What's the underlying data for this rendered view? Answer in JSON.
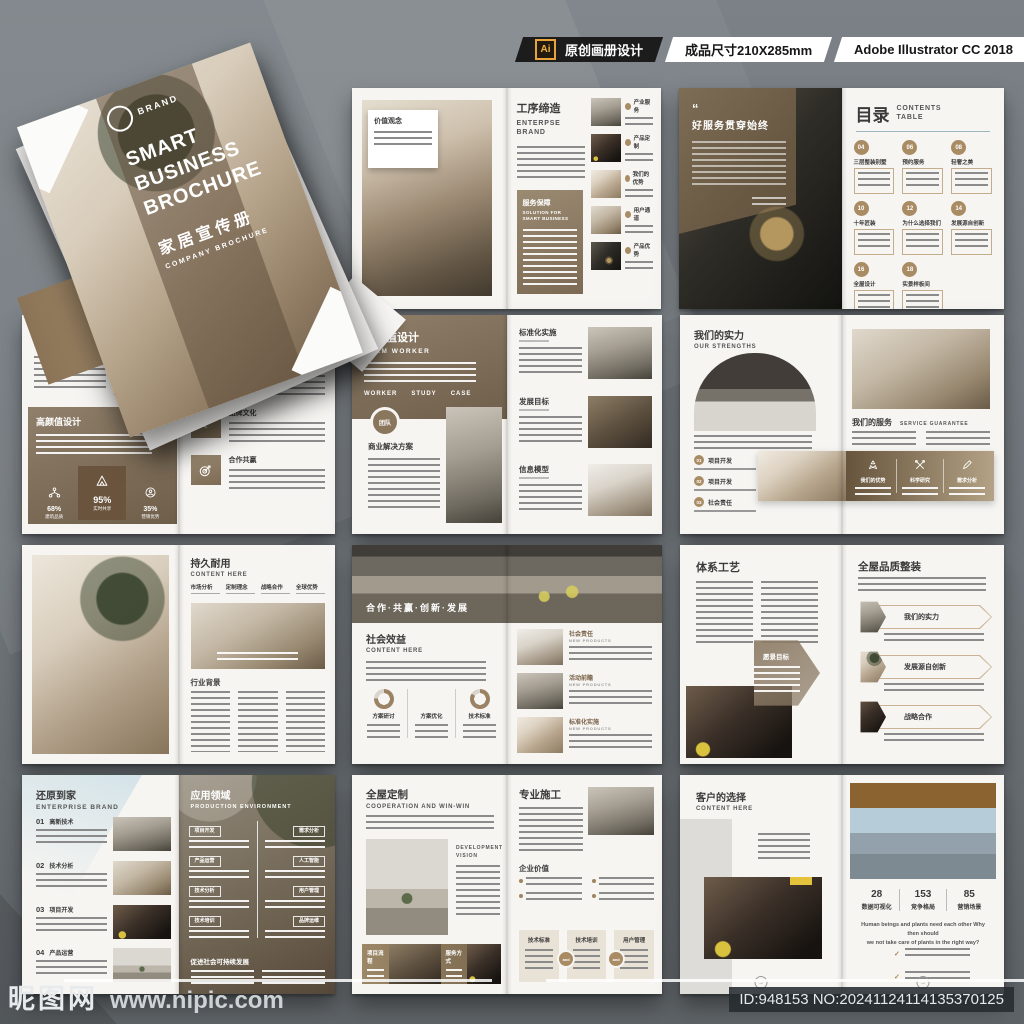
{
  "header": {
    "ai_badge": "Ai",
    "label_design": "原创画册设计",
    "label_size": "成品尺寸210X285mm",
    "label_software": "Adobe Illustrator CC 2018"
  },
  "watermark": {
    "site_name": "昵图网",
    "site_url": "www.nipic.com",
    "image_id": "ID:948153 NO:20241124114135370125"
  },
  "cover": {
    "logo_text": "BRAND",
    "title_line1": "SMART",
    "title_line2": "BUSINESS",
    "title_line3": "BROCHURE",
    "subtitle_cn": "家居宣传册",
    "subtitle_en": "COMPANY BROCHURE"
  },
  "spread_craft": {
    "tag": "价值观念",
    "title": "工序缔造",
    "subtitle": "ENTERPSE BRAND",
    "panel_title": "服务保障",
    "panel_subtitle": "SOLUTION FOR SMART BUSINESS",
    "items": [
      {
        "label": "产业服务"
      },
      {
        "label": "产品定制"
      },
      {
        "label": "我们的优势"
      },
      {
        "label": "用户通道"
      },
      {
        "label": "产品优势"
      }
    ]
  },
  "spread_contents": {
    "quote_mark": "“",
    "quote": "好服务贯穿始终",
    "title": "目录",
    "subtitle": "CONTENTS TABLE",
    "entries": [
      {
        "num": "04",
        "label": "三层整装别墅"
      },
      {
        "num": "06",
        "label": "预约服务"
      },
      {
        "num": "08",
        "label": "轻奢之美"
      },
      {
        "num": "10",
        "label": "十年匠装"
      },
      {
        "num": "12",
        "label": "为什么选择我们"
      },
      {
        "num": "14",
        "label": "发展源自创新"
      },
      {
        "num": "16",
        "label": "全屋设计"
      },
      {
        "num": "18",
        "label": "实景样板间"
      }
    ]
  },
  "spread_brand": {
    "title": "一线大品牌主材",
    "subtitle": "CONTENT HERE",
    "panel_title": "高颜值设计",
    "stats": [
      {
        "value": "68%",
        "label": "建筑品质"
      },
      {
        "value": "95%",
        "label": "实时共享"
      },
      {
        "value": "35%",
        "label": "营销优势"
      }
    ],
    "features": [
      {
        "label": "产业服务"
      },
      {
        "label": "品牌文化"
      },
      {
        "label": "合作共赢"
      }
    ]
  },
  "spread_team": {
    "title": "高颜值设计",
    "subtitle": "TEAM WORKER",
    "tabs": [
      "WORKER",
      "STUDY",
      "CASE"
    ],
    "badge": "团队",
    "heading2": "商业解决方案",
    "sections": [
      {
        "label": "标准化实施"
      },
      {
        "label": "发展目标"
      },
      {
        "label": "信息模型"
      }
    ]
  },
  "spread_strength": {
    "title": "我们的实力",
    "subtitle": "OUR STRENGTHS",
    "numbered": [
      {
        "num": "01",
        "label": "项目开发"
      },
      {
        "num": "02",
        "label": "项目开发"
      },
      {
        "num": "03",
        "label": "社会责任"
      }
    ],
    "service_title": "我们的服务",
    "service_subtitle": "SERVICE GUARANTEE",
    "band_items": [
      {
        "label": "我们的优势"
      },
      {
        "label": "科学研究"
      },
      {
        "label": "需求分析"
      }
    ]
  },
  "spread_durable": {
    "title": "持久耐用",
    "subtitle": "CONTENT HERE",
    "columns": [
      {
        "label": "市场分析"
      },
      {
        "label": "定制理念"
      },
      {
        "label": "战略合作"
      },
      {
        "label": "全球优势"
      }
    ],
    "heading2": "行业背景"
  },
  "spread_social": {
    "banner": "合作·共赢·创新·发展",
    "title": "社会效益",
    "subtitle": "CONTENT HERE",
    "donuts": [
      {
        "label": "方案研讨"
      },
      {
        "label": "方案优化"
      },
      {
        "label": "技术标准"
      }
    ],
    "items": [
      {
        "label": "社会责任",
        "sub": "NEW PRODUCTS"
      },
      {
        "label": "活动前瞻",
        "sub": "NEW PRODUCTS"
      },
      {
        "label": "标准化实施",
        "sub": "NEW PRODUCTS"
      }
    ]
  },
  "spread_system": {
    "title": "体系工艺",
    "hex_label": "愿景目标",
    "right_title": "全屋品质整装",
    "arrows": [
      {
        "label": "我们的实力"
      },
      {
        "label": "发展源自创新"
      },
      {
        "label": "战略合作"
      }
    ]
  },
  "spread_home": {
    "title": "还原到家",
    "subtitle": "ENTERPRISE BRAND",
    "numbered": [
      {
        "num": "01",
        "label": "高新技术"
      },
      {
        "num": "02",
        "label": "技术分析"
      },
      {
        "num": "03",
        "label": "项目开发"
      },
      {
        "num": "04",
        "label": "产品运营"
      }
    ],
    "right_title": "应用领域",
    "right_subtitle": "PRODUCTION ENVIRONMENT",
    "pills_left": [
      "项目开发",
      "产品运营",
      "技术分析",
      "技术培训"
    ],
    "pills_right": [
      "需求分析",
      "人工智能",
      "用户管理",
      "品牌运维"
    ],
    "footer": "促进社会可持续发展"
  },
  "spread_custom": {
    "title": "全屋定制",
    "subtitle": "COOPERATION AND WIN-WIN",
    "vision": "DEVELOPMENT VISION",
    "band_labels": [
      "项目流程",
      "服务方式"
    ],
    "right_title": "专业施工",
    "heading2": "企业价值",
    "boxes": [
      "技术标准",
      "技术培训",
      "用户管理"
    ],
    "joiner": "and"
  },
  "spread_choice": {
    "title": "客户的选择",
    "subtitle": "CONTENT HERE",
    "stats": [
      {
        "value": "28",
        "label": "数据可视化"
      },
      {
        "value": "153",
        "label": "竞争格局"
      },
      {
        "value": "85",
        "label": "营销场景"
      }
    ],
    "en_line1": "Human beings and plants need each other Why then should",
    "en_line2": "we not take care of plants in the right way?"
  }
}
